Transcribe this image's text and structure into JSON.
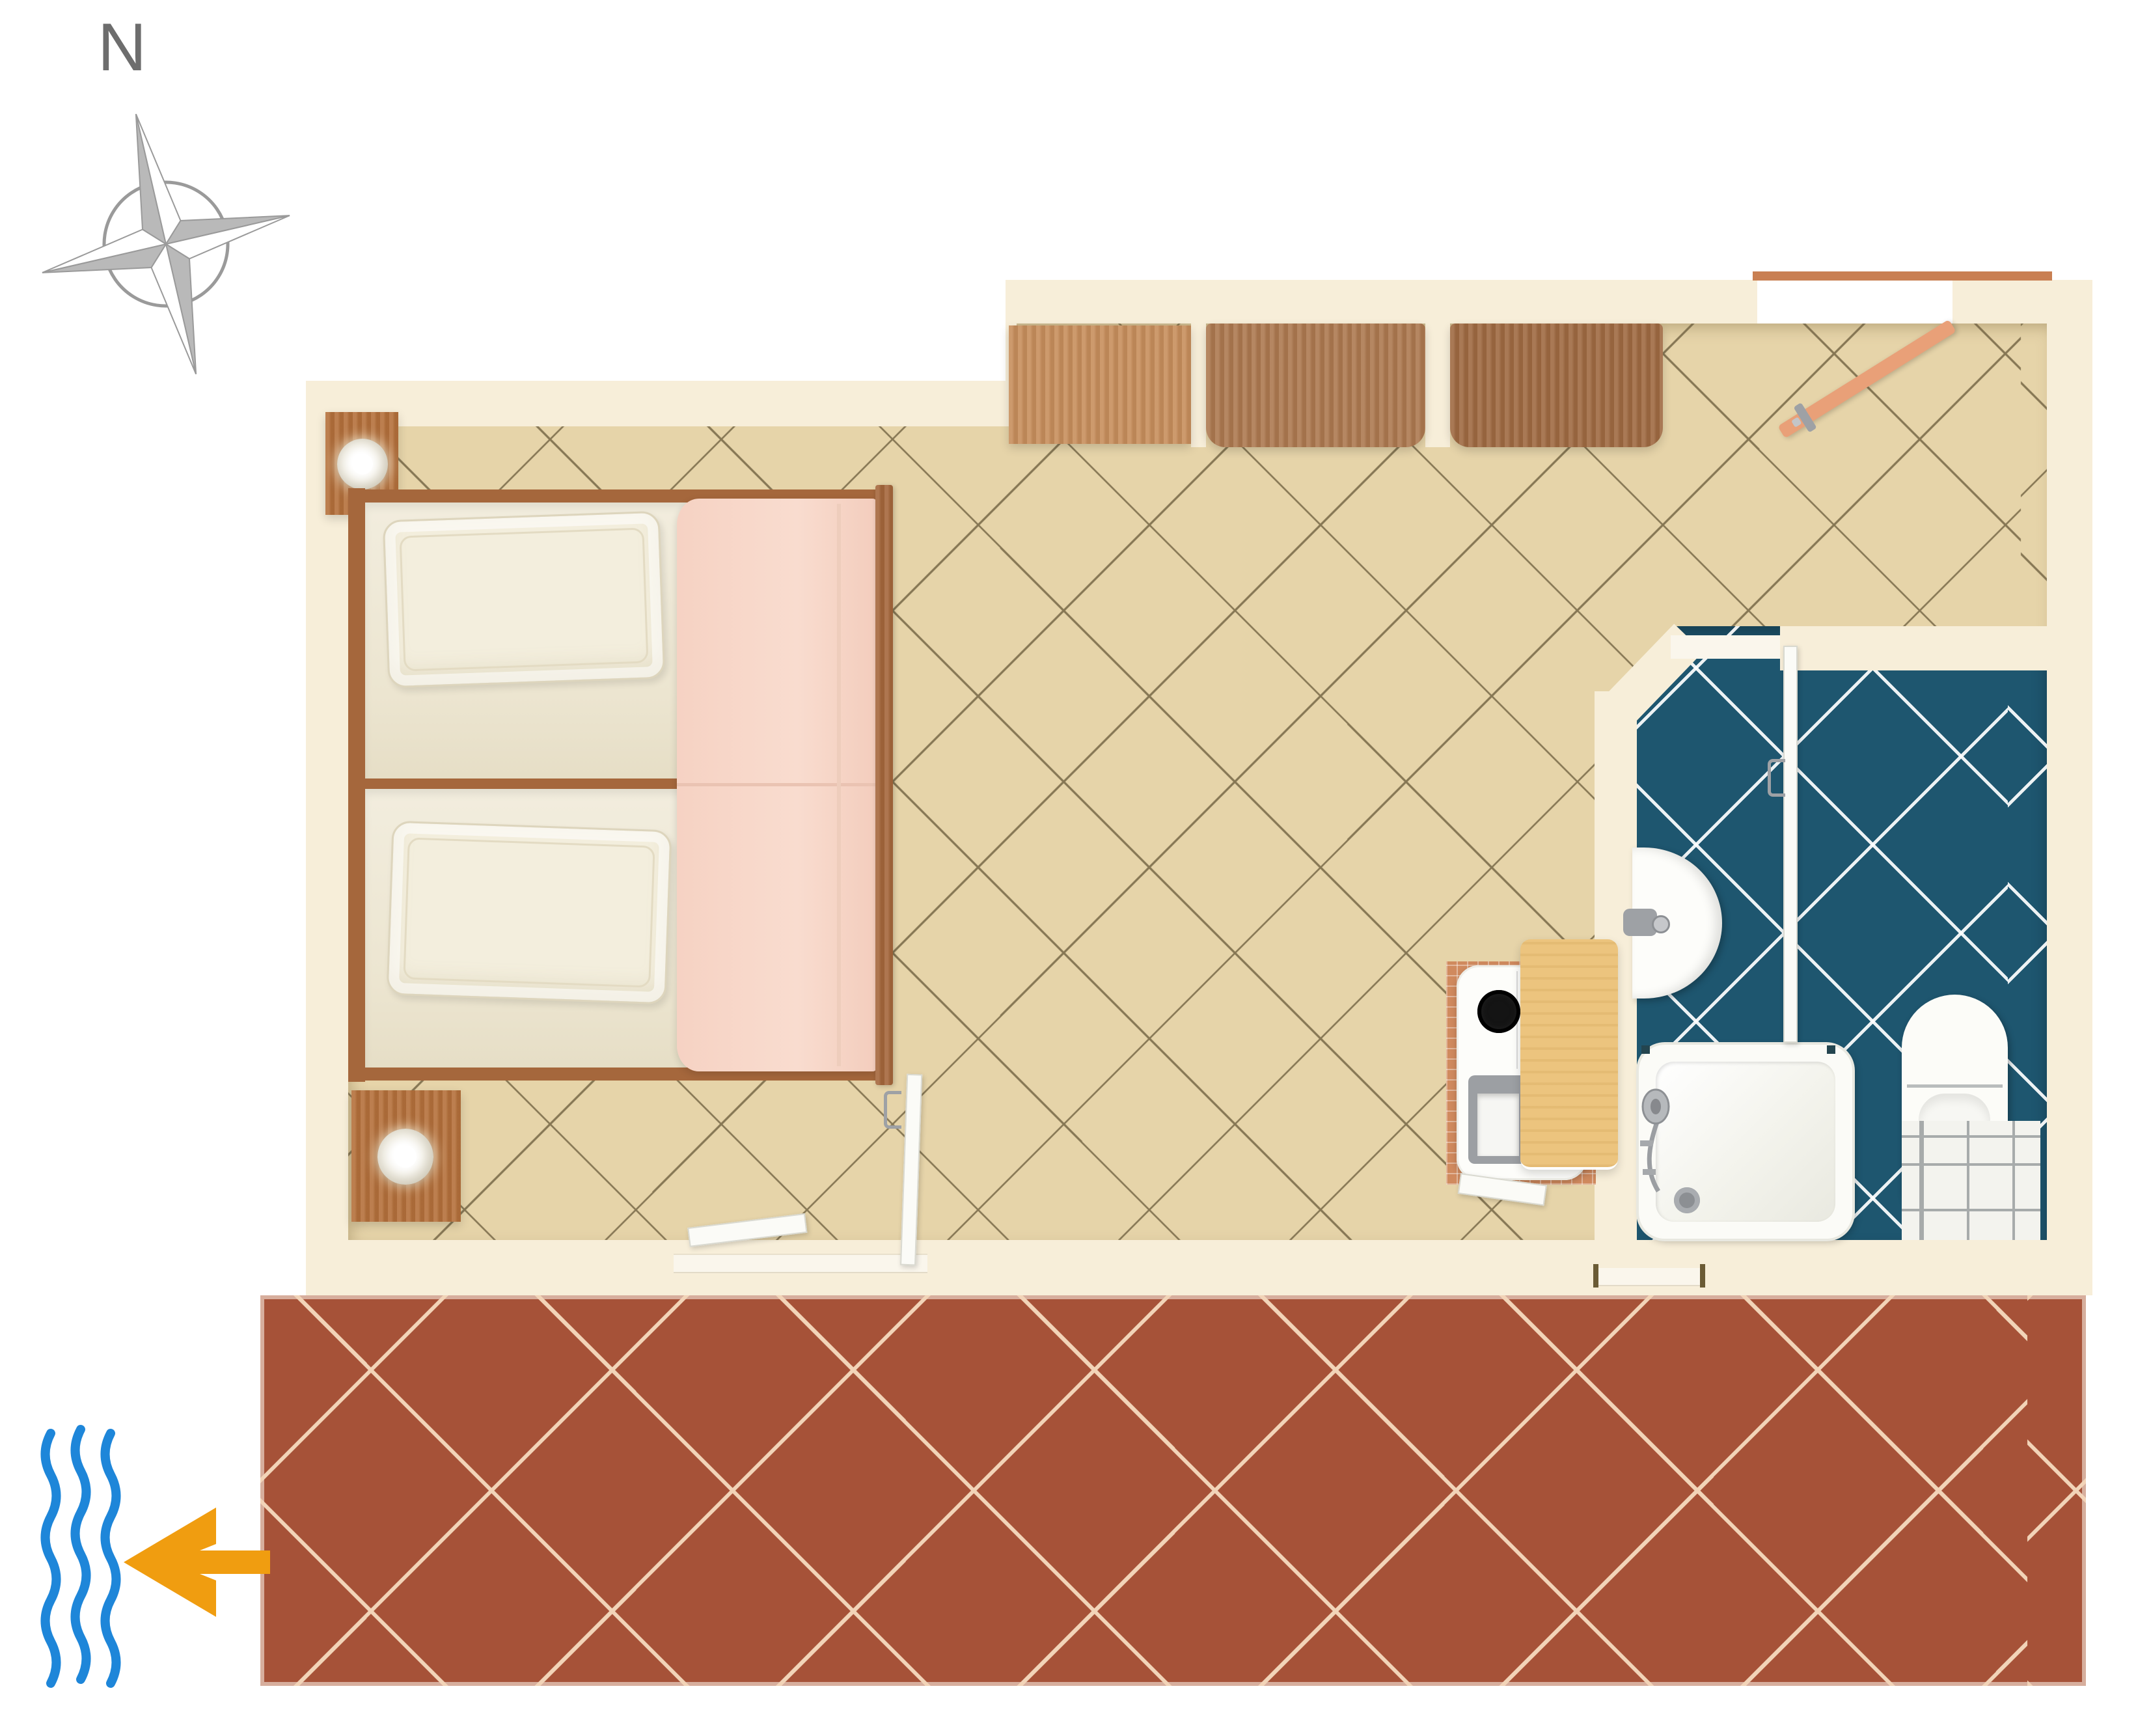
{
  "compass": {
    "label": "N"
  },
  "colors": {
    "page_bg": "#ffffff",
    "wall": "#f7eed9",
    "floor_main": "#e6d4a9",
    "floor_grout": "#6f6040",
    "bathroom_floor": "#1e566f",
    "bathroom_grout": "#ffffff",
    "terrace_floor": "#a65238",
    "terrace_grout": "#f2d4b8",
    "cabinet_light": "#c78e5c",
    "cabinet_medium": "#ad7950",
    "cabinet_dark": "#9f6a42",
    "wood_bed": "#a5673c",
    "wood_nightstand": "#b4703b",
    "mattress_white": "#efe9d8",
    "blanket_pink": "#f8d8ca",
    "blanket_seam": "#eac3b2",
    "fixture_white": "#fbfbf7",
    "threshold_white": "#faf6ec",
    "entry_door_salmon": "#e9a078",
    "entry_threshold_orange": "#c97f52",
    "table_pine": "#ecc47e",
    "kitchen_tile_terracotta": "#d08a5e",
    "sink_gray": "#9c9fa3",
    "metal_gray": "#9ea1a5",
    "burner_black": "#141414",
    "mat_white": "#f3f3ee",
    "arrow_orange": "#f09d10",
    "wave_blue": "#1e86d9",
    "compass_gray": "#b9b9b9",
    "compass_outline": "#9a9a9a",
    "label_gray": "#6d6d6d"
  },
  "plan": {
    "rooms": [
      "bedroom-living-area",
      "bathroom",
      "entrance-hall",
      "terrace"
    ],
    "furniture": [
      "twin-bed-upper",
      "twin-bed-lower",
      "pillow-upper",
      "pillow-lower",
      "pink-blanket",
      "nightstand-upper",
      "nightstand-lower",
      "bedside-lamp-upper",
      "bedside-lamp-lower",
      "wardrobe-cabinet-1",
      "wardrobe-cabinet-2",
      "wardrobe-cabinet-3",
      "kitchenette-counter",
      "stove-burner",
      "kitchen-sink",
      "dining-table",
      "washbasin",
      "shower-tray",
      "shower-head",
      "toilet",
      "bathroom-floor-mat"
    ],
    "doors": [
      "entrance-door",
      "bathroom-door",
      "terrace-door-left-leaf",
      "terrace-door-right-leaf",
      "terrace-window"
    ],
    "symbols": [
      "compass-rose",
      "north-label",
      "sea-waves",
      "sea-direction-arrow"
    ]
  }
}
